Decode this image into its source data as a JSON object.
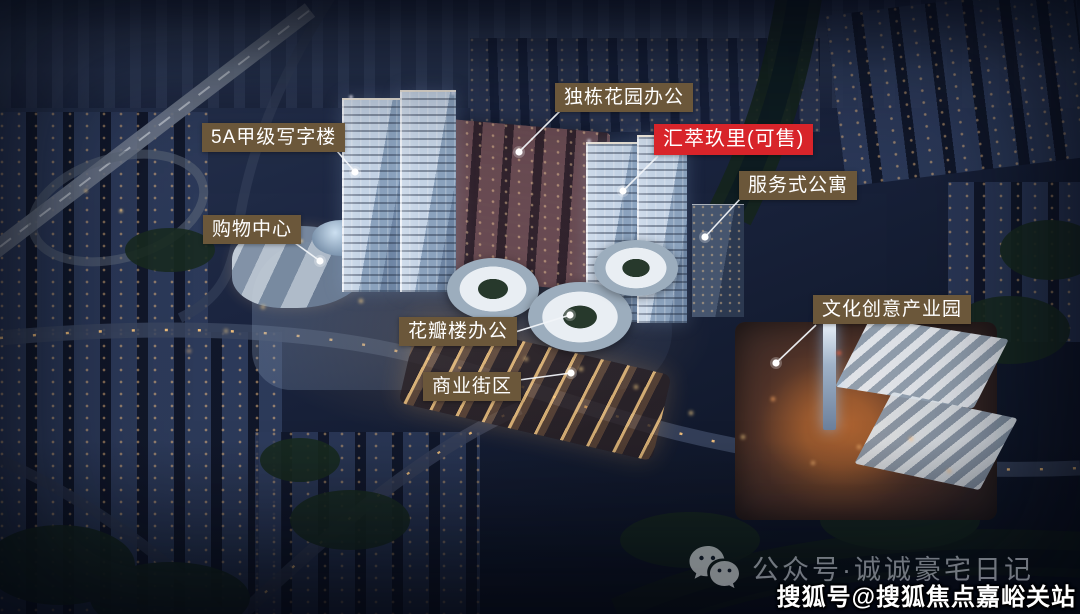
{
  "callouts": [
    {
      "id": "office-5a",
      "text": "5A甲级写字楼",
      "highlight": false
    },
    {
      "id": "garden-office",
      "text": "独栋花园办公",
      "highlight": false
    },
    {
      "id": "huicui-jiuli",
      "text": "汇萃玖里(可售)",
      "highlight": true
    },
    {
      "id": "serviced-apartment",
      "text": "服务式公寓",
      "highlight": false
    },
    {
      "id": "shopping-center",
      "text": "购物中心",
      "highlight": false
    },
    {
      "id": "culture-creative-park",
      "text": "文化创意产业园",
      "highlight": false
    },
    {
      "id": "petal-office",
      "text": "花瓣楼办公",
      "highlight": false
    },
    {
      "id": "commercial-street",
      "text": "商业街区",
      "highlight": false
    }
  ],
  "watermarks": {
    "wechat_account": "公众号·诚诚豪宅日记",
    "souhu_account": "搜狐号@搜狐焦点嘉峪关站"
  },
  "icons": {
    "wechat": "wechat-icon"
  },
  "colors": {
    "callout_bg": "#6b573a",
    "callout_text": "#ffffff",
    "highlight_bg": "#d8242a",
    "highlight_text": "#ffffff",
    "wechat_watermark_text": "#c7ccd6",
    "souhu_watermark_text": "#ffffff"
  }
}
